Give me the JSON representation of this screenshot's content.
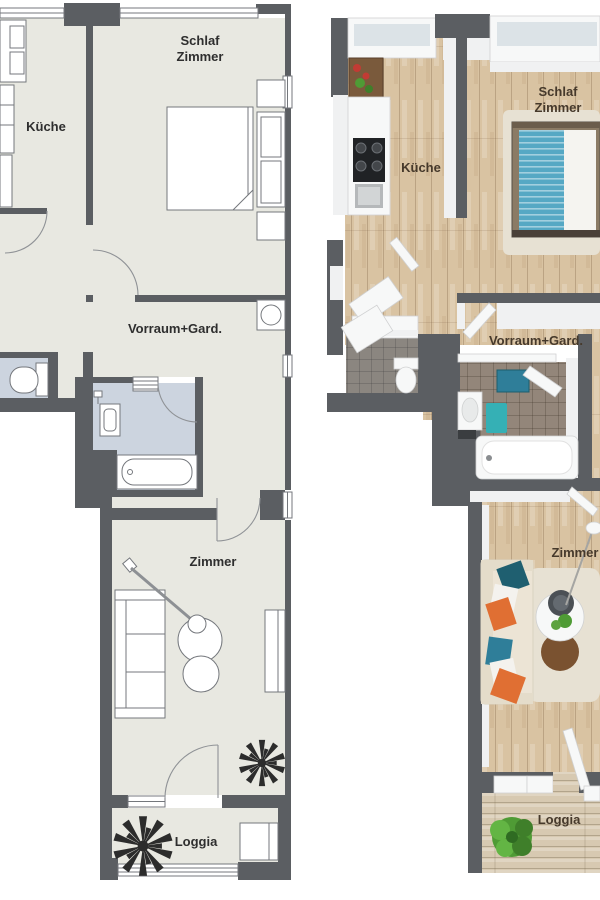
{
  "colors": {
    "wall": "#5b5e62",
    "floor2d": "#e8e8e1",
    "bath2d": "#ccd4df",
    "stroke2d": "#74777c",
    "label2d": "#2e2e2e",
    "label3d": "#46392b",
    "wood": "#d9c3a2",
    "loggiaWood": "#d7c9b1",
    "tileBath": "#93867a",
    "tileWc": "#8b8680",
    "glass": "#dce3e7",
    "face3d": "#f0f1f2",
    "bedTeal": "#56a8c4",
    "sofaCream": "#ece4d5",
    "pillowTealDark": "#1f5f70",
    "pillowTeal": "#2f7e99",
    "pillowOrange": "#e06f33",
    "rugBeige": "#e7e1d3",
    "rugBrown": "#7a5230",
    "plantGreen": "#4f9b35",
    "tableBrown": "#7a5a3c",
    "flowerRed": "#c23b34"
  },
  "plans": {
    "left": {
      "labels": {
        "schlaf_line1": "Schlaf",
        "schlaf_line2": "Zimmer",
        "kueche": "Küche",
        "vorraum": "Vorraum+Gard.",
        "zimmer": "Zimmer",
        "loggia": "Loggia"
      }
    },
    "right": {
      "labels": {
        "schlaf_line1": "Schlaf",
        "schlaf_line2": "Zimmer",
        "kueche": "Küche",
        "vorraum": "Vorraum+Gard.",
        "zimmer": "Zimmer",
        "loggia": "Loggia"
      }
    }
  }
}
